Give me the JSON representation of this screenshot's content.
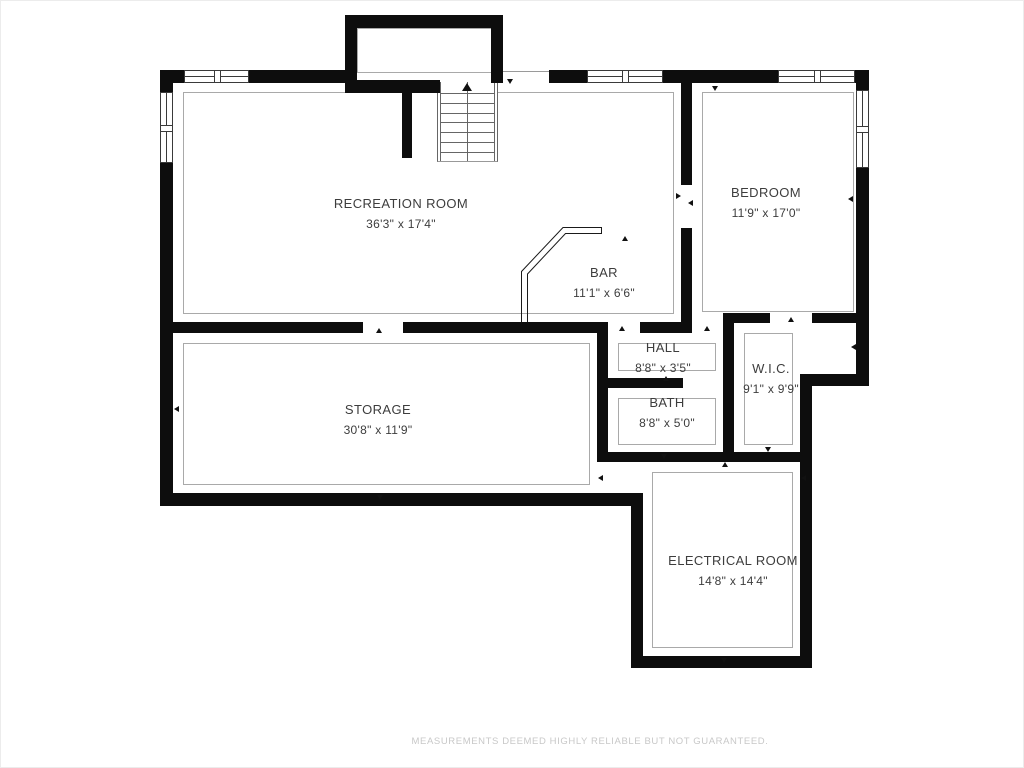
{
  "plan": {
    "type": "basement floor plan",
    "rooms": [
      {
        "id": "recreation-room",
        "name": "RECREATION ROOM",
        "dimensions": "36'3\" x 17'4\""
      },
      {
        "id": "bedroom",
        "name": "BEDROOM",
        "dimensions": "11'9\" x 17'0\""
      },
      {
        "id": "bar",
        "name": "BAR",
        "dimensions": "11'1\" x 6'6\""
      },
      {
        "id": "hall",
        "name": "HALL",
        "dimensions": "8'8\" x 3'5\""
      },
      {
        "id": "wic",
        "name": "W.I.C.",
        "dimensions": "9'1\" x 9'9\""
      },
      {
        "id": "bath",
        "name": "BATH",
        "dimensions": "8'8\" x 5'0\""
      },
      {
        "id": "storage",
        "name": "STORAGE",
        "dimensions": "30'8\" x 11'9\""
      },
      {
        "id": "electrical-room",
        "name": "ELECTRICAL ROOM",
        "dimensions": "14'8\" x 14'4\""
      }
    ],
    "stairs": {
      "direction_icon": "up-arrow"
    },
    "disclaimer": "MEASUREMENTS DEEMED HIGHLY RELIABLE BUT NOT GUARANTEED."
  },
  "colors": {
    "wall": "#0d0d0d",
    "label_text": "#3d3d3d",
    "thin_outline": "#a9a9a9",
    "disclaimer_text": "#c8c8c8",
    "background": "#ffffff"
  }
}
